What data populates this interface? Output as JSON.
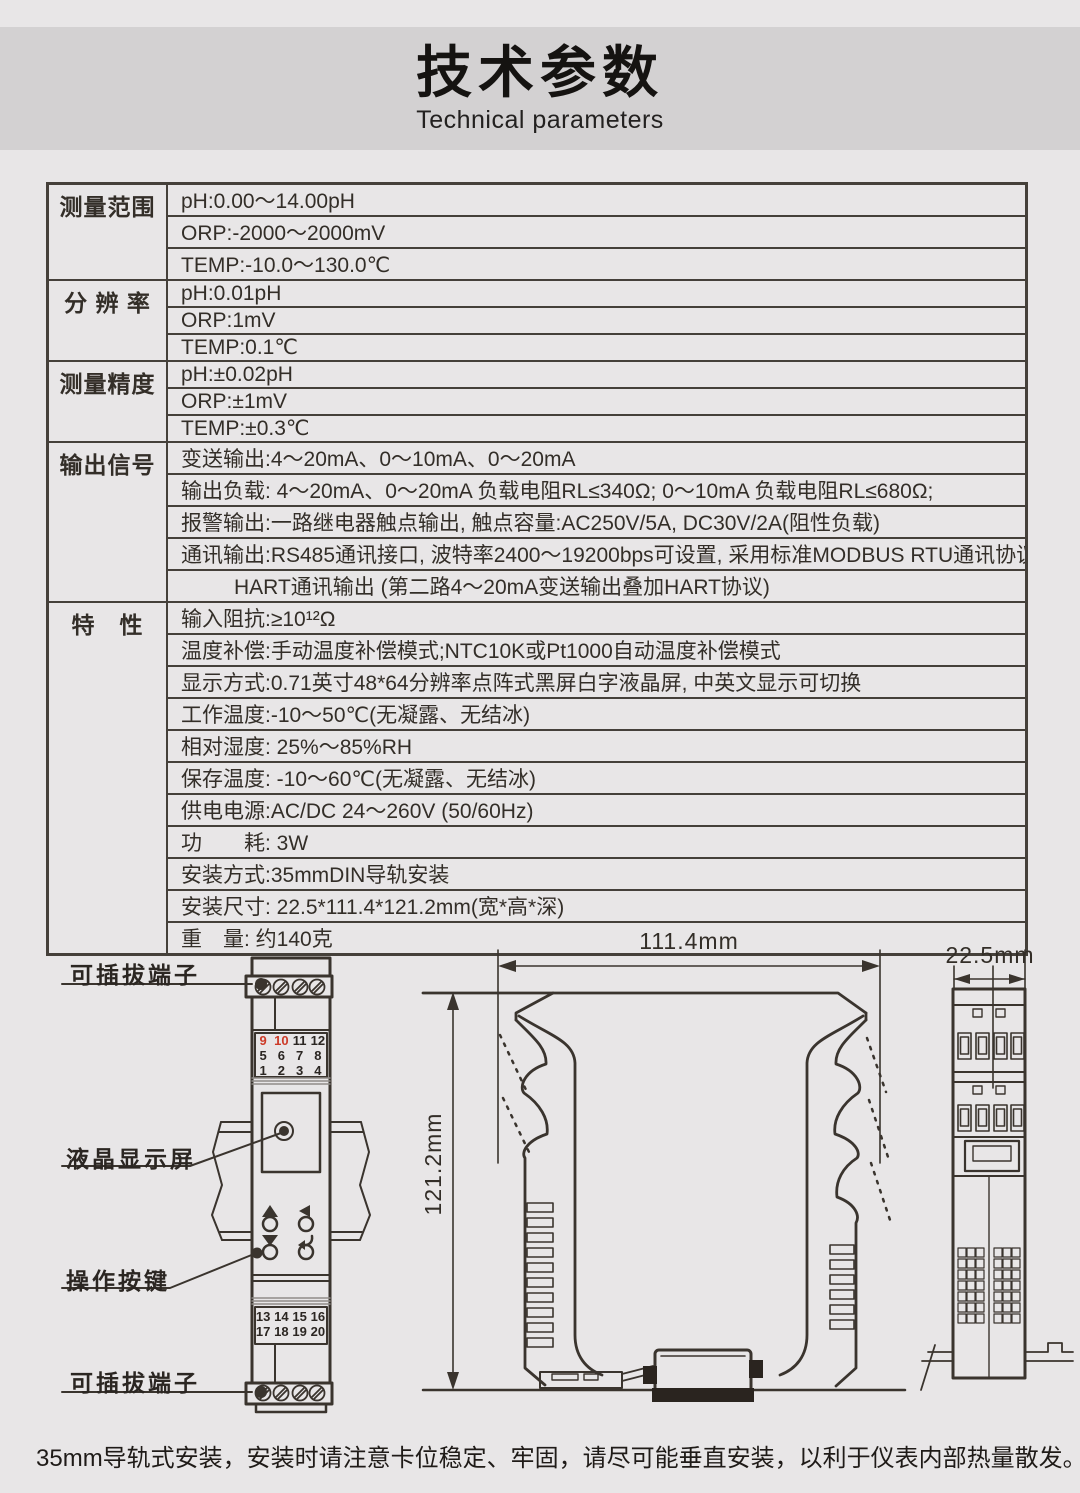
{
  "colors": {
    "page_bg": "#e8e6e7",
    "band_bg": "#d3d1d2",
    "ink": "#3a342e",
    "table_line": "#45403a",
    "red_accent": "#cc3a27"
  },
  "header": {
    "title": "技术参数",
    "subtitle": "Technical parameters"
  },
  "table": {
    "groups": [
      {
        "label": "测量范围",
        "rows": [
          {
            "text": "pH:0.00～14.00pH"
          },
          {
            "text": "ORP:-2000～2000mV"
          },
          {
            "text": "TEMP:-10.0～130.0℃"
          }
        ]
      },
      {
        "label": "分 辨 率",
        "rows": [
          {
            "text": "pH:0.01pH"
          },
          {
            "text": "ORP:1mV"
          },
          {
            "text": "TEMP:0.1℃"
          }
        ]
      },
      {
        "label": "测量精度",
        "rows": [
          {
            "text": "pH:±0.02pH"
          },
          {
            "text": "ORP:±1mV"
          },
          {
            "text": "TEMP:±0.3℃"
          }
        ]
      },
      {
        "label": "输出信号",
        "rows": [
          {
            "text": "变送输出:4～20mA、0～10mA、0～20mA"
          },
          {
            "text": "输出负载: 4～20mA、0～20mA 负载电阻RL≤340Ω; 0～10mA 负载电阻RL≤680Ω;"
          },
          {
            "text": "报警输出:一路继电器触点输出, 触点容量:AC250V/5A, DC30V/2A(阻性负载)"
          },
          {
            "text": "通讯输出:RS485通讯接口, 波特率2400～19200bps可设置, 采用标准MODBUS RTU通讯协议"
          },
          {
            "text": "HART通讯输出 (第二路4～20mA变送输出叠加HART协议)",
            "indent": true
          }
        ]
      },
      {
        "label": "特　性",
        "rows": [
          {
            "text": "输入阻抗:≥10¹²Ω"
          },
          {
            "text": "温度补偿:手动温度补偿模式;NTC10K或Pt1000自动温度补偿模式"
          },
          {
            "text": "显示方式:0.71英寸48*64分辨率点阵式黑屏白字液晶屏, 中英文显示可切换"
          },
          {
            "text": "工作温度:-10～50℃(无凝露、无结冰)"
          },
          {
            "text": "相对湿度: 25%～85%RH"
          },
          {
            "text": "保存温度: -10～60℃(无凝露、无结冰)"
          },
          {
            "text": "供电电源:AC/DC 24～260V (50/60Hz)"
          },
          {
            "text": "功　　耗: 3W"
          },
          {
            "text": "安装方式:35mmDIN导轨安装"
          },
          {
            "text": "安装尺寸: 22.5*111.4*121.2mm(宽*高*深)"
          },
          {
            "text": "重　量: 约140克"
          }
        ]
      }
    ]
  },
  "drawings": {
    "front_view": {
      "label_top_terminal": "可插拔端子",
      "label_lcd": "液晶显示屏",
      "label_buttons": "操作按键",
      "label_bottom_terminal": "可插拔端子",
      "top_terminal_rows": [
        [
          "9",
          "10",
          "11",
          "12"
        ],
        [
          "5",
          "6",
          "7",
          "8"
        ],
        [
          "1",
          "2",
          "3",
          "4"
        ]
      ],
      "red_terminals": [
        "9",
        "10"
      ],
      "bottom_terminal_rows": [
        [
          "13",
          "14",
          "15",
          "16"
        ],
        [
          "17",
          "18",
          "19",
          "20"
        ]
      ]
    },
    "side_view": {
      "width_label": "111.4mm",
      "depth_label": "121.2mm"
    },
    "end_view": {
      "width_label": "22.5mm"
    }
  },
  "footer": {
    "note": "35mm导轨式安装，安装时请注意卡位稳定、牢固，请尽可能垂直安装，以利于仪表内部热量散发。"
  }
}
